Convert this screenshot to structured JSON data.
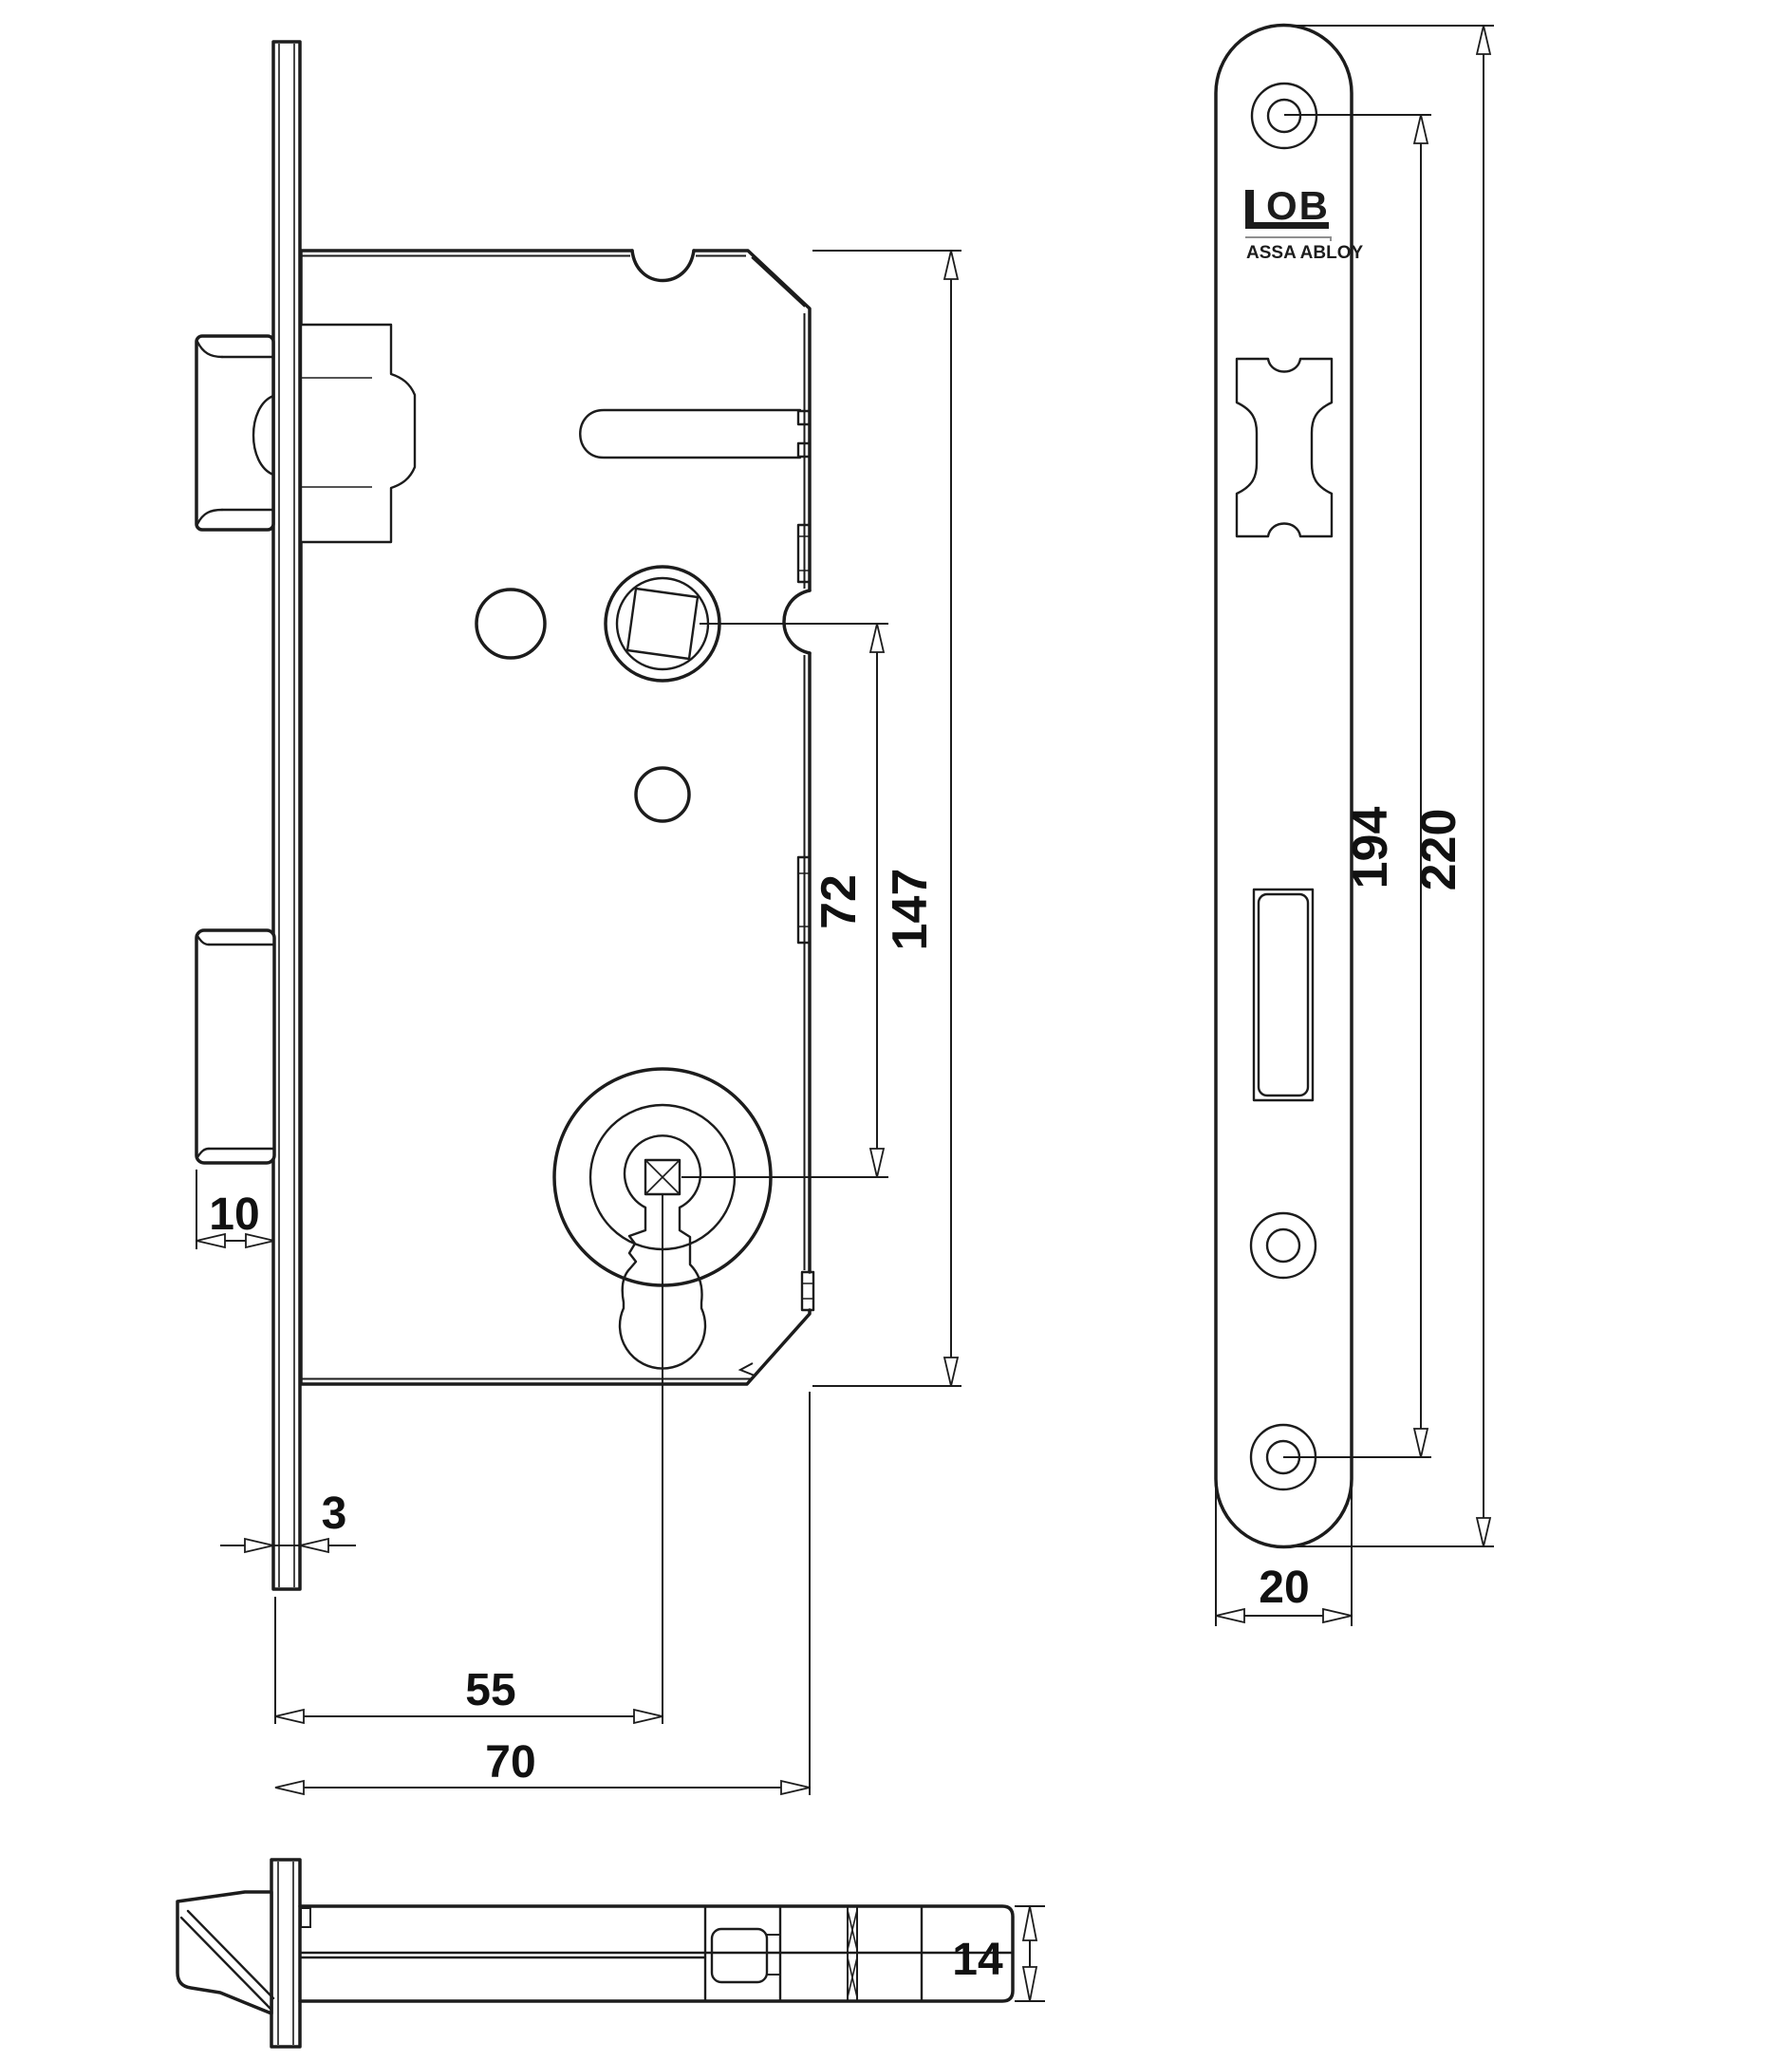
{
  "page": {
    "background_color": "#ffffff",
    "line_color": "#1c1c1c",
    "description": "Mortise lock technical drawing with side view, faceplate front view and latch bottom view"
  },
  "logo": {
    "brand": "LOB",
    "brand_mark_letters": "OB",
    "parent_company": "ASSA ABLOY"
  },
  "dims": {
    "deadbolt_throw": "10",
    "faceplate_thickness": "3",
    "backset": "55",
    "case_depth": "70",
    "spindle_to_cylinder": "72",
    "case_height": "147",
    "screw_hole_spacing": "194",
    "faceplate_length": "220",
    "faceplate_width": "20",
    "latch_bolt_height": "14"
  }
}
